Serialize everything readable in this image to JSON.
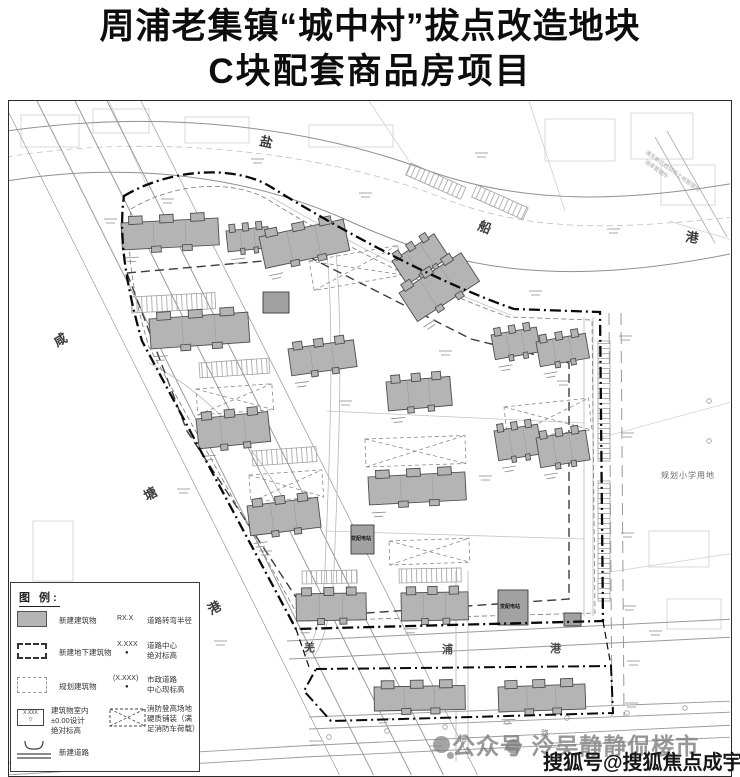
{
  "title": {
    "line1": "周浦老集镇“城中村”拔点改造地块",
    "line2": "C块配套商品房项目"
  },
  "waterways": {
    "top_canal": {
      "name": "盐船港",
      "chars": [
        "盐",
        "船",
        "港"
      ]
    },
    "west_canal": {
      "name": "咸塘港",
      "chars": [
        "咸",
        "塘",
        "港"
      ]
    },
    "south_canal": {
      "name": "羌浦港",
      "chars": [
        "羌",
        "浦",
        "港"
      ]
    }
  },
  "road_labels": {
    "char1": "浦",
    "char2": "路"
  },
  "annotations": {
    "school_parcel": "规划小学用地",
    "agency_line1": "浦东新区规划和土地管理局",
    "agency_line2": "油库管理所",
    "facility": "变配电站"
  },
  "legend": {
    "title": "图 例:",
    "dot": "●",
    "elevation_mark": "▽",
    "elevation_swatch_text": "X.XXX",
    "left_rows": [
      {
        "label": "新建建筑物"
      },
      {
        "label": "新建地下建筑物"
      },
      {
        "label": "规划建筑物"
      },
      {
        "line1": "建筑物室内",
        "line2": "±0.00设计",
        "line3": "绝对标高"
      },
      {
        "label": "新建道路"
      }
    ],
    "right_rows": [
      {
        "symbol": "RX.X",
        "label": "道路转弯半径"
      },
      {
        "symbol": "X.XXX",
        "line1": "道路中心",
        "line2": "绝对标高"
      },
      {
        "symbol": "(X.XXX)",
        "line1": "市政道路",
        "line2": "中心现标高"
      },
      {
        "line1": "消防登高场地",
        "line2": "硬质铺装（满",
        "line3": "足消防车荷载）"
      }
    ]
  },
  "watermarks": {
    "gray_text": "公众号 泠吴静静侃楼市",
    "dark_text": "搜狐号@搜狐焦点成宇站"
  }
}
